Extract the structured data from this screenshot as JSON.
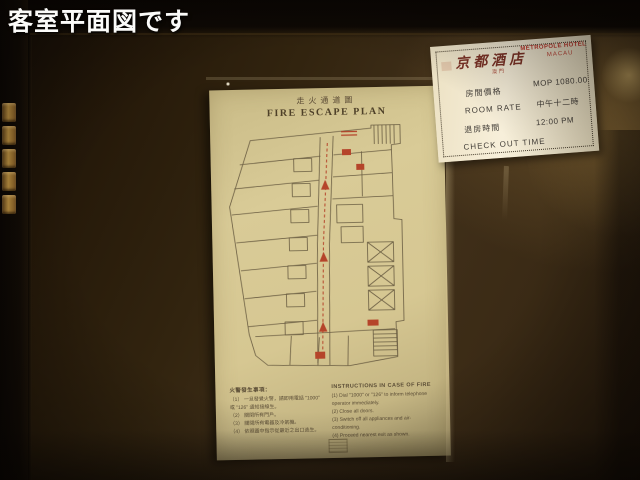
{
  "scene": {
    "caption": "客室平面図です"
  },
  "poster": {
    "title_zh": "走火通道圖",
    "title_en": "FIRE ESCAPE PLAN",
    "instructions": {
      "zh": {
        "header": "火警發生事項：",
        "items": [
          "（1） 一旦發覺火警，請即用電話 \"1000\" 或 \"126\" 通知接線生。",
          "（2） 關閉所有門戶。",
          "（3） 關閉所有電器及冷氣機。",
          "（4） 依照圖中指示從最近之出口逃生。"
        ]
      },
      "en": {
        "header": "INSTRUCTIONS IN CASE OF FIRE",
        "items": [
          "(1) Dial \"1000\" or \"126\" to inform telephone operator immediately.",
          "(2) Close all doors.",
          "(3) Switch off all appliances and air-conditioning.",
          "(4) Proceed nearest exit as shown."
        ]
      }
    }
  },
  "rate_card": {
    "hotel_name_zh": "京都酒店",
    "hotel_name_en": "METROPOLE HOTEL",
    "hotel_location_en": "MACAU",
    "hotel_location_zh": "澳門",
    "labels": [
      "房間價格",
      "ROOM RATE",
      "退房時間",
      "CHECK OUT TIME"
    ],
    "values": [
      "MOP 1080.00",
      "中午十二時",
      "12:00 PM"
    ]
  },
  "colors": {
    "escape_route_red": "#b5442a",
    "poster_cream": "#d8ca96",
    "card_red": "#c23b30",
    "hinge_gold": "#c79a45"
  }
}
